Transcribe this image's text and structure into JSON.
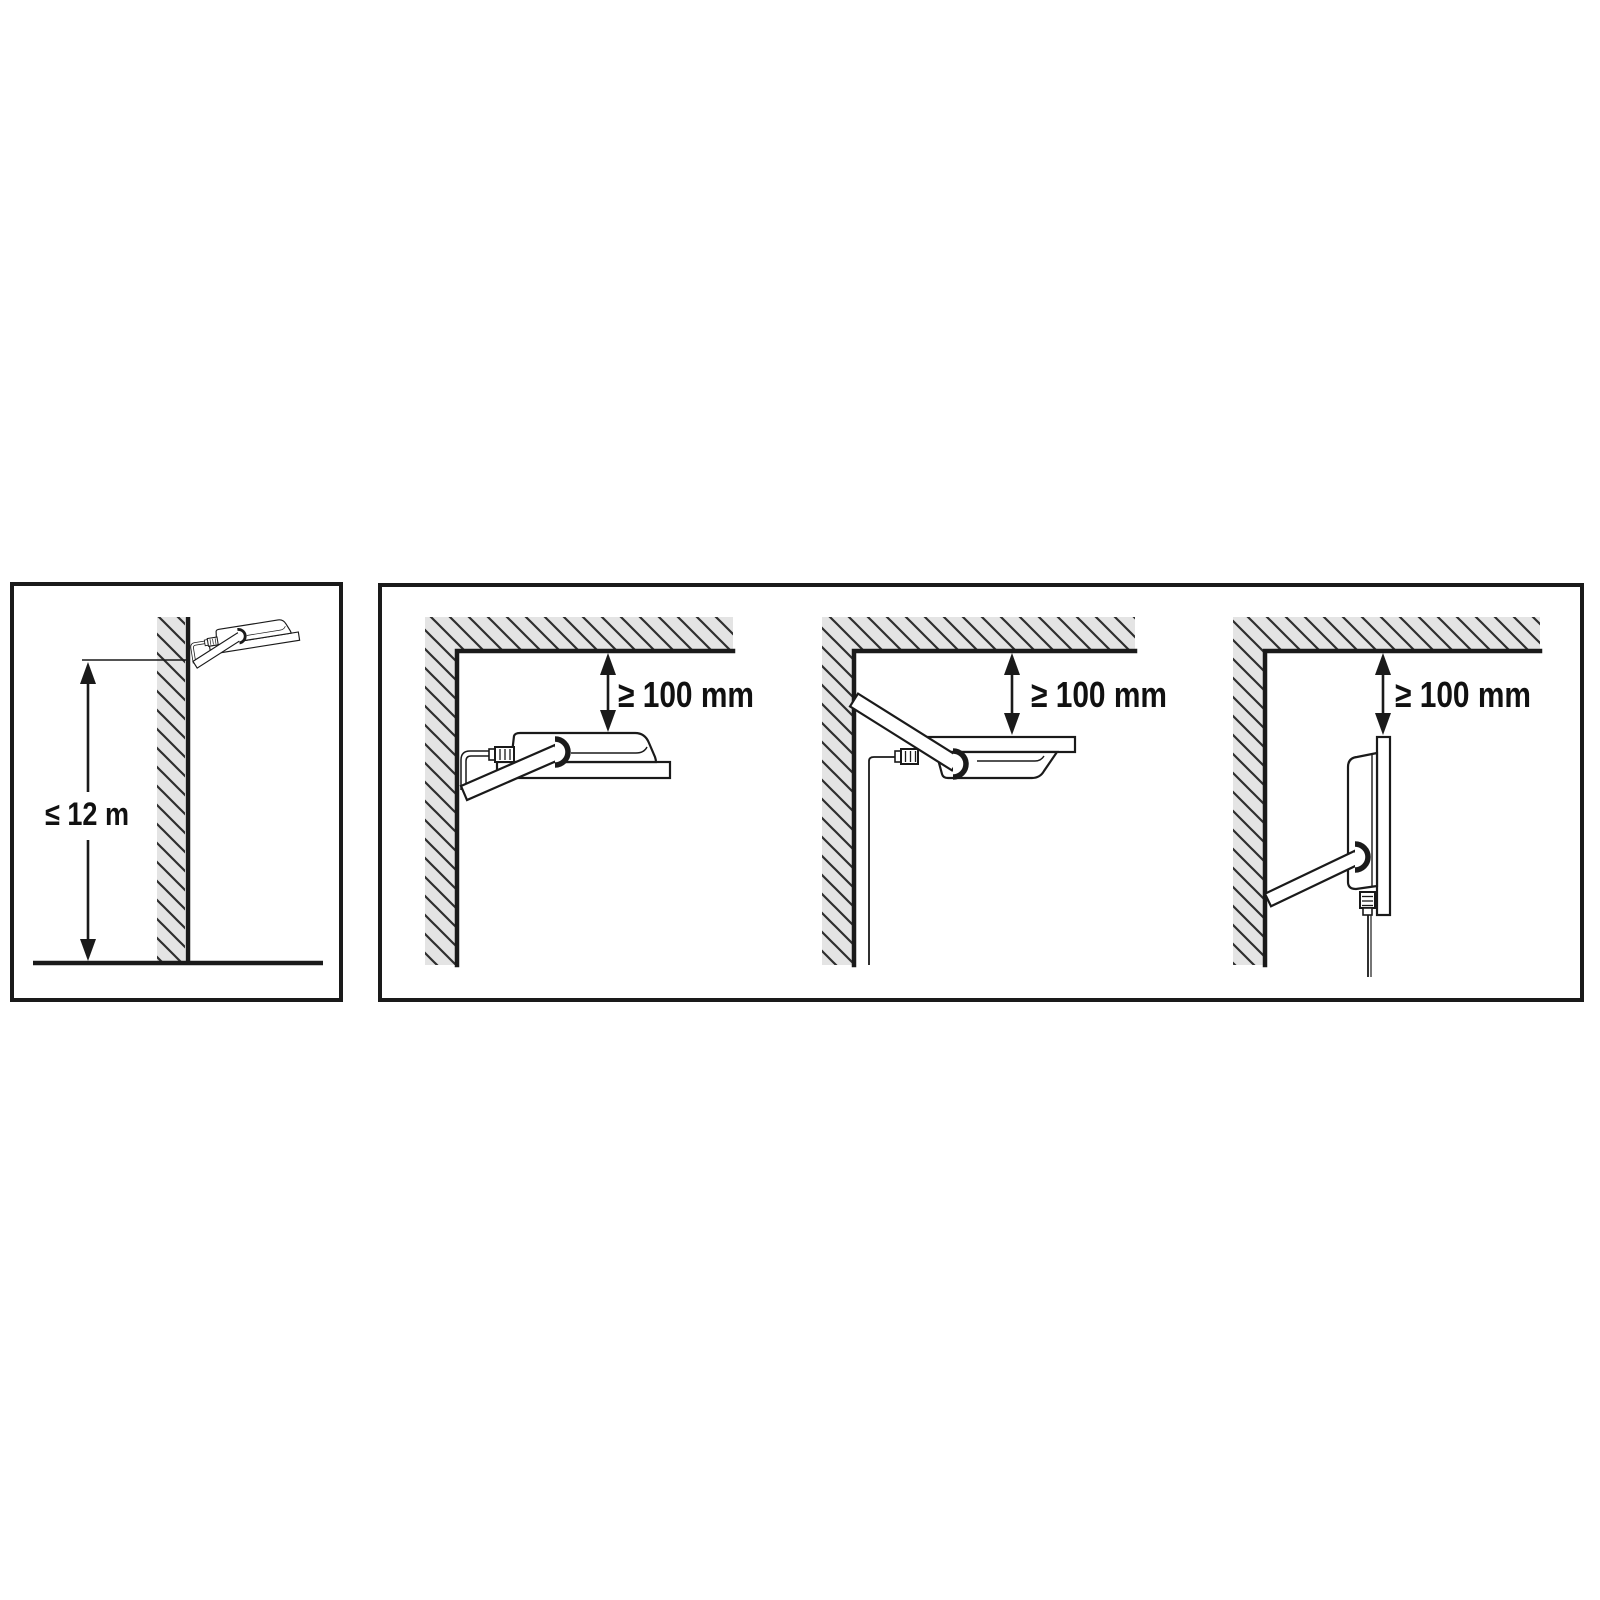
{
  "diagram": {
    "type": "floodlight-installation-clearance-diagram",
    "colors": {
      "line": "#1a1a1a",
      "hatch_fill": "#e4e4e4",
      "hatch_stroke": "#2e2e2e",
      "background": "#ffffff",
      "text": "#111111"
    },
    "left_panel": {
      "name": "max-mounting-height",
      "dimension_label": "≤ 12 m"
    },
    "right_panel": {
      "name": "min-ceiling-clearance",
      "diagrams": [
        {
          "clearance_label": "≥ 100 mm",
          "floodlight_orientation": "aimed-down-forward"
        },
        {
          "clearance_label": "≥ 100 mm",
          "floodlight_orientation": "aimed-up"
        },
        {
          "clearance_label": "≥ 100 mm",
          "floodlight_orientation": "aimed-forward"
        }
      ]
    }
  }
}
